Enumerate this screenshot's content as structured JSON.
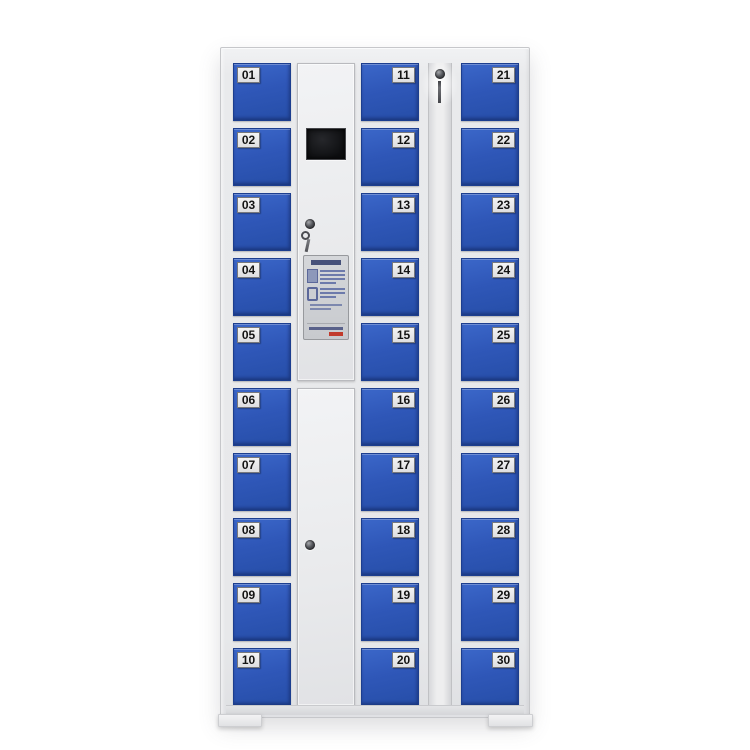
{
  "product": {
    "kind": "electronic-storage-locker-cabinet",
    "door_count": 30
  },
  "locker_columns": [
    {
      "name": "left",
      "label_side": "left",
      "doors": [
        "01",
        "02",
        "03",
        "04",
        "05",
        "06",
        "07",
        "08",
        "09",
        "10"
      ]
    },
    {
      "name": "middle",
      "label_side": "right",
      "doors": [
        "11",
        "12",
        "13",
        "14",
        "15",
        "16",
        "17",
        "18",
        "19",
        "20"
      ]
    },
    {
      "name": "right",
      "label_side": "right",
      "doors": [
        "21",
        "22",
        "23",
        "24",
        "25",
        "26",
        "27",
        "28",
        "29",
        "30"
      ]
    }
  ],
  "control_column": {
    "display_screen_icon": "black-lcd-screen",
    "upper_lock_icon": "key-lock-with-hanging-keys",
    "instruction_sticker_icon": "usage-instruction-sticker",
    "sticker_pictograms": [
      "card-reader-icon",
      "mobile-phone-icon",
      "red-seal-mark"
    ],
    "lower_lock_icon": "round-cam-lock"
  },
  "key_panel": {
    "lock_icon": "key-lock-with-hanging-key"
  },
  "colors": {
    "door_blue": "#2f57b8",
    "door_blue_highlight": "#3b67c9",
    "door_border": "#1c3e8f",
    "frame": "#e8e9eb",
    "frame_edge": "#c6c7ca",
    "number_label_bg": "#ececec",
    "number_label_text": "#141414",
    "screen_black": "#0d0e10",
    "sticker_bg": "#ced0d4",
    "sticker_red": "#c13a2c",
    "background": "#ffffff"
  }
}
